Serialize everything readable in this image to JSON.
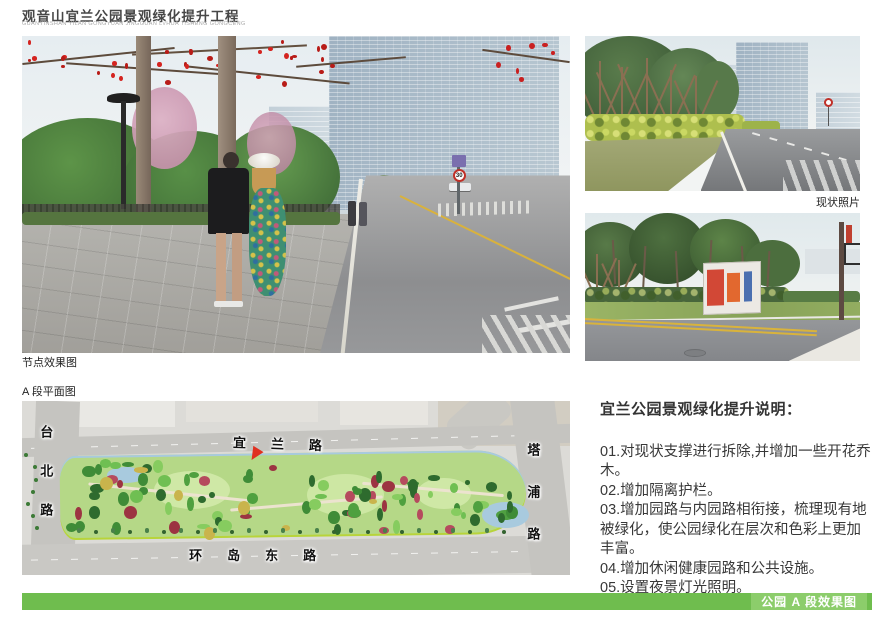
{
  "header": {
    "title": "观音山宜兰公园景观绿化提升工程",
    "subtitle": "GUANYINSHAN YILAN GONGYUAN JINGGUAN LVHUA TISHENG GONGCENG"
  },
  "labels": {
    "node_render": "节点效果图",
    "plan": "A 段平面图",
    "status_photos": "现状照片"
  },
  "main_photo": {
    "speed_limit": "30"
  },
  "plan": {
    "roads": {
      "left": "台北路",
      "top": "宜兰路",
      "bottom": "环岛东路",
      "right": "塔浦路"
    }
  },
  "notes": {
    "heading": "宜兰公园景观绿化提升说明：",
    "items": [
      "01.对现状支撑进行拆除,并增加一些开花乔木。",
      "02.增加隔离护栏。",
      "03.增加园路与内园路相衔接，梳理现有地被绿化，使公园绿化在层次和色彩上更加丰富。",
      "04.增加休闲健康园路和公共设施。",
      "05.设置夜景灯光照明。"
    ]
  },
  "footer": {
    "bar_label": "公园 A 段效果图"
  },
  "colors": {
    "bar_green": "#6fbd4e",
    "bar_green_light": "#8ccd6b",
    "park_green": "#b5d887",
    "water_blue": "#a8cade",
    "marker_red": "#e03020"
  }
}
